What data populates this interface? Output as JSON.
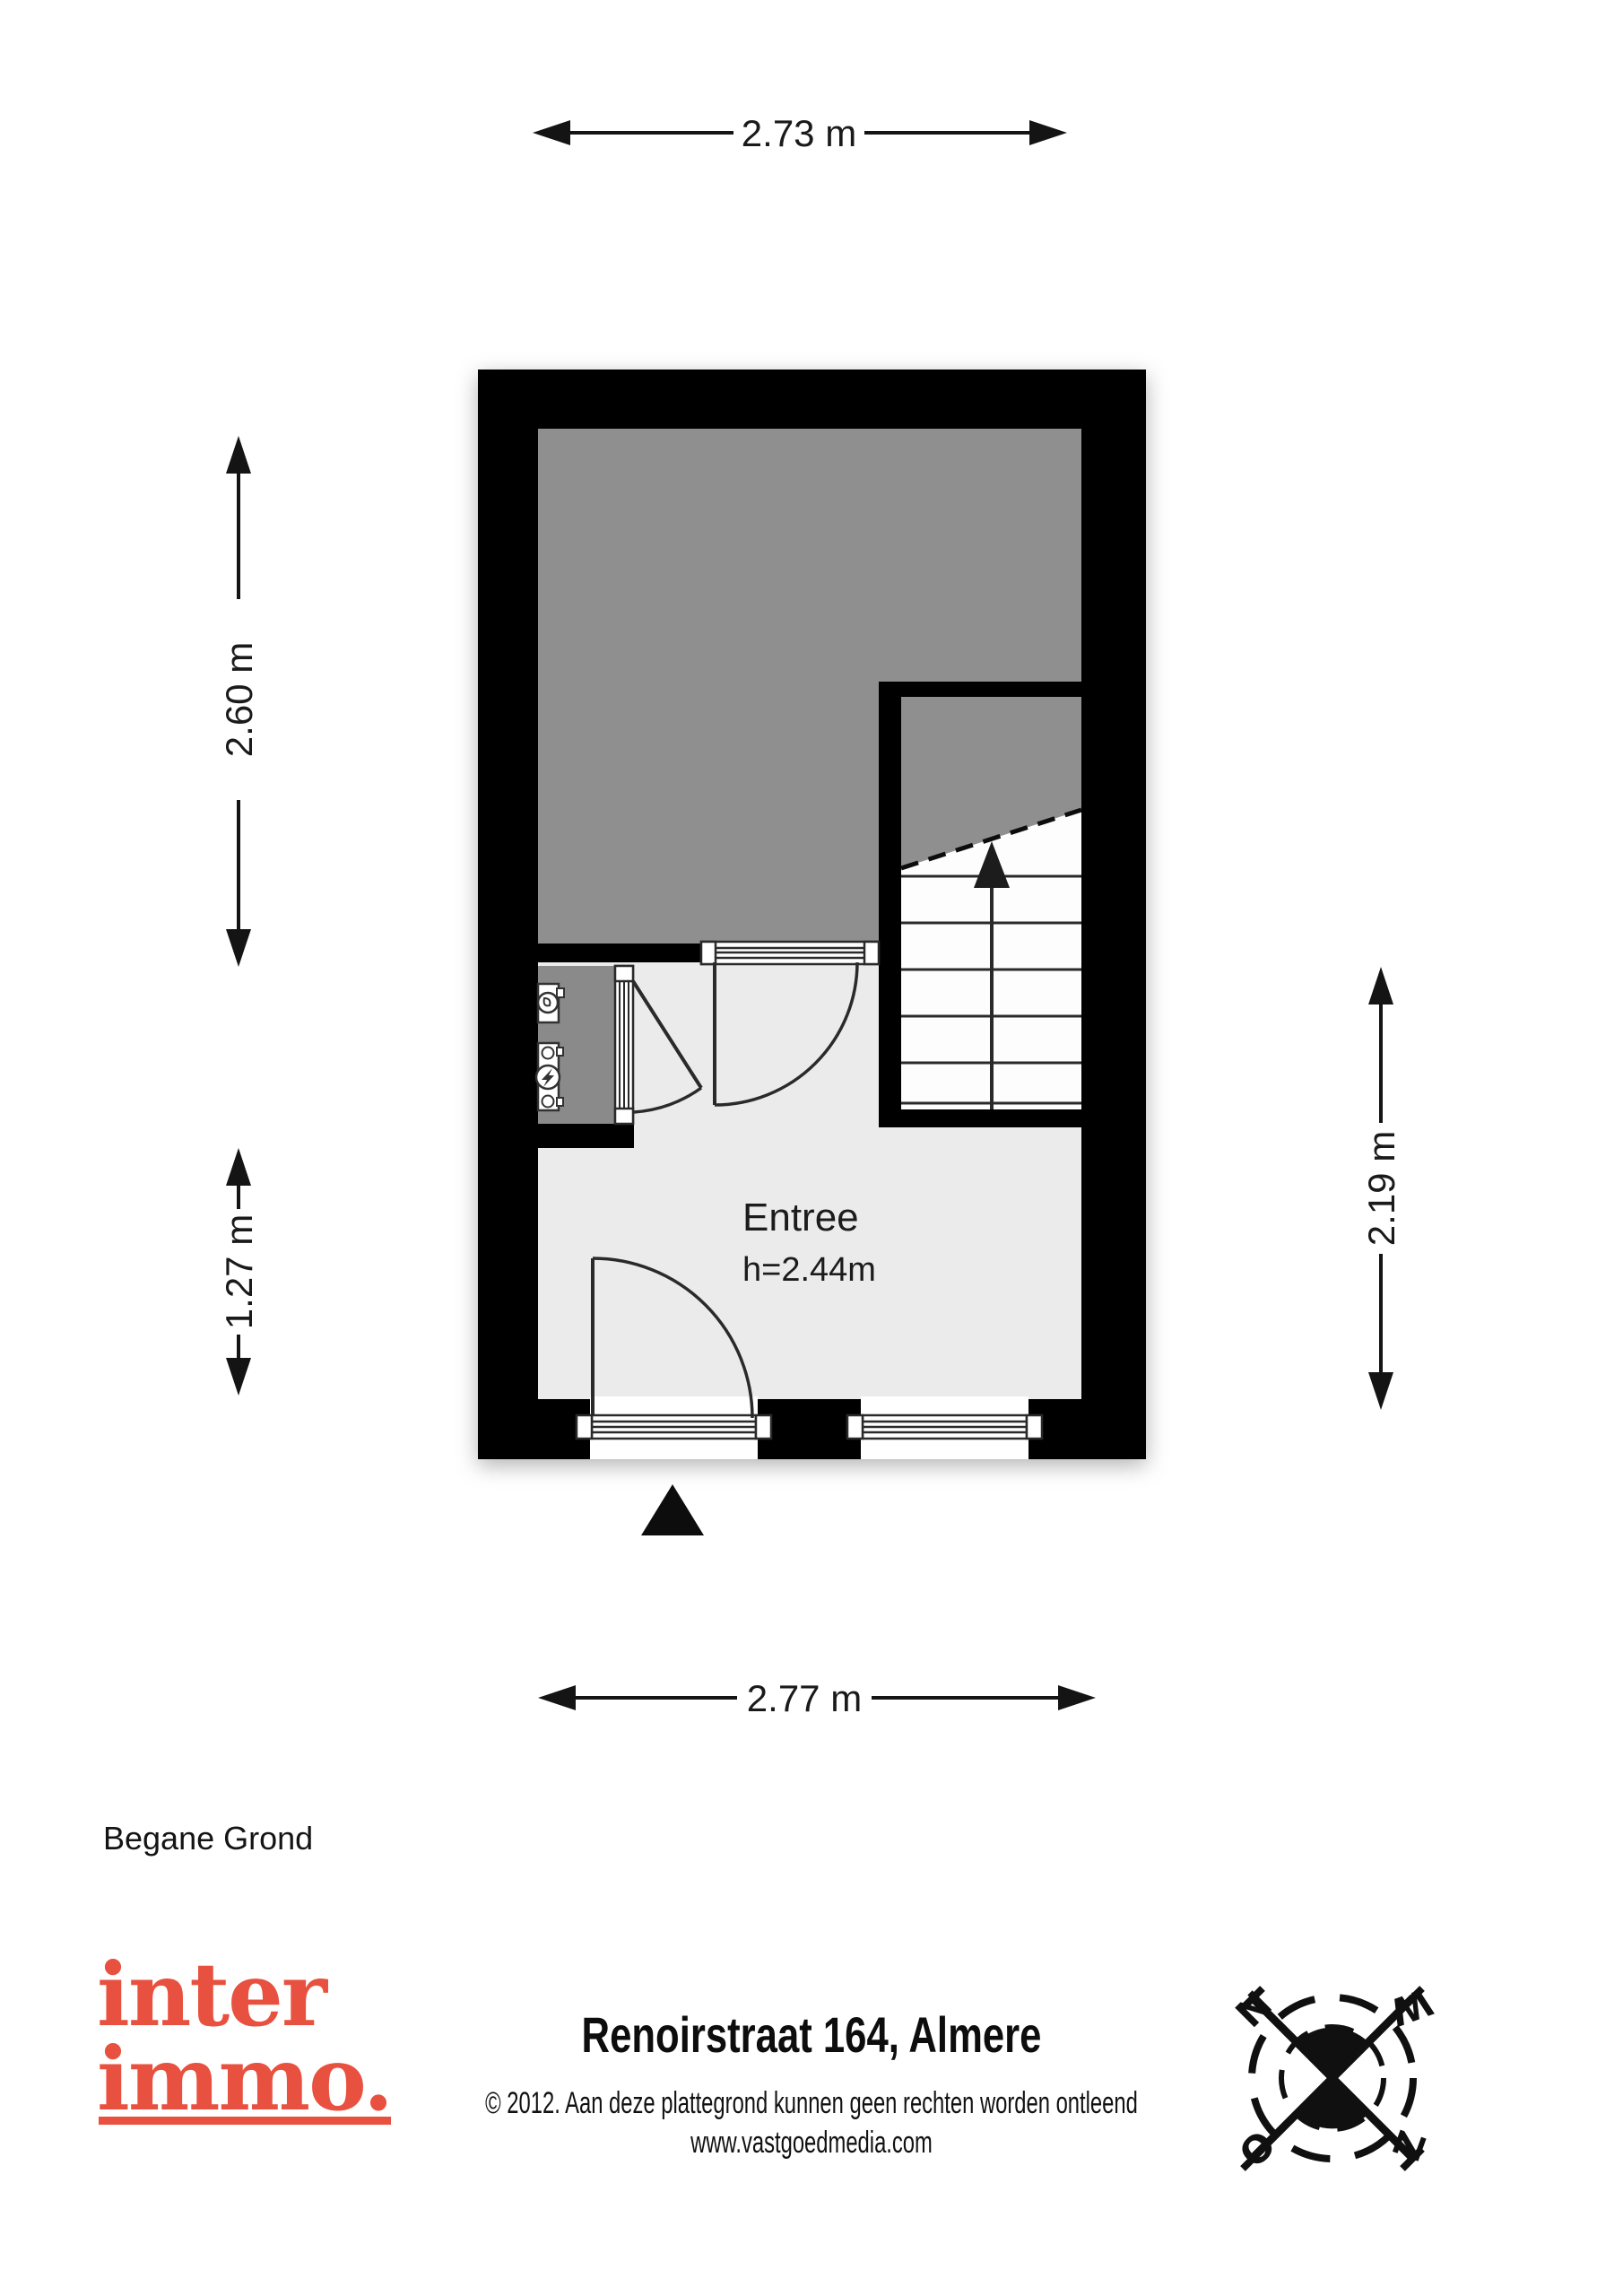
{
  "floorplan": {
    "floor_label": "Begane Grond",
    "room": {
      "name": "Entree",
      "ceiling_height": "h=2.44m"
    },
    "dimensions": {
      "top": "2.73 m",
      "left_upper": "2.60 m",
      "left_lower": "1.27 m",
      "right": "2.19 m",
      "bottom": "2.77 m"
    },
    "features": {
      "stairs": "staircase with up arrow",
      "meter_cupboard": "meter cupboard with water and electricity meters",
      "entrance_marker": "triangle at front door"
    },
    "colors": {
      "wall": "#000000",
      "room_gray": "#8f8f8f",
      "closet_gray": "#8a8a8a",
      "entree_floor": "#ebebeb",
      "stair_floor": "#fdfdfd"
    }
  },
  "footer": {
    "logo": {
      "line1": "inter",
      "line2": "immo.",
      "color": "#e8513f"
    },
    "title": "Renoirstraat 164, Almere",
    "copyright_line1": "© 2012. Aan deze plattegrond kunnen geen rechten worden ontleend",
    "copyright_line2": "www.vastgoedmedia.com",
    "compass": {
      "labels": [
        "N",
        "W",
        "O",
        "Z"
      ]
    }
  }
}
